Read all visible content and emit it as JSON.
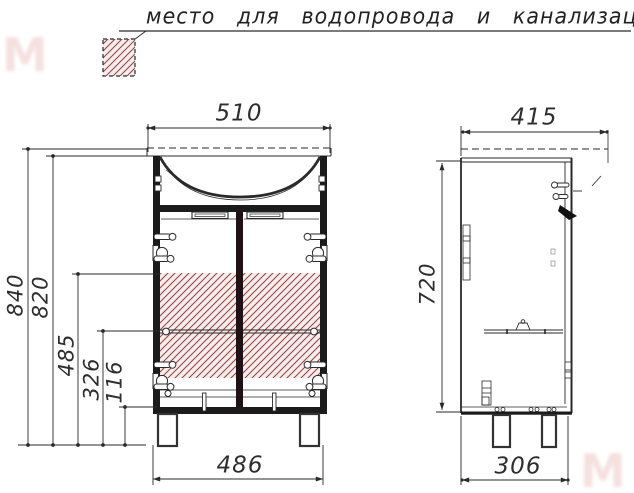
{
  "title": {
    "label": "место для водопровода и канализации"
  },
  "legend": {
    "swatch": "hatched-area-symbol"
  },
  "front_view": {
    "name": "front-view",
    "dim_width_top": "510",
    "dim_height_total": "840",
    "dim_height_cabinet": "820",
    "dim_hatch_top": "485",
    "dim_shelf": "326",
    "dim_plinth": "116",
    "dim_width_bottom": "486"
  },
  "side_view": {
    "name": "side-view",
    "dim_depth_top": "415",
    "dim_height_body": "720",
    "dim_depth_bottom": "306"
  },
  "colors": {
    "ink": "#2a2a2a",
    "hatch_line": "#95413f",
    "hatch_bg": "#f8eded",
    "watermark": "#d9948c"
  },
  "watermark": {
    "glyph": "M"
  }
}
